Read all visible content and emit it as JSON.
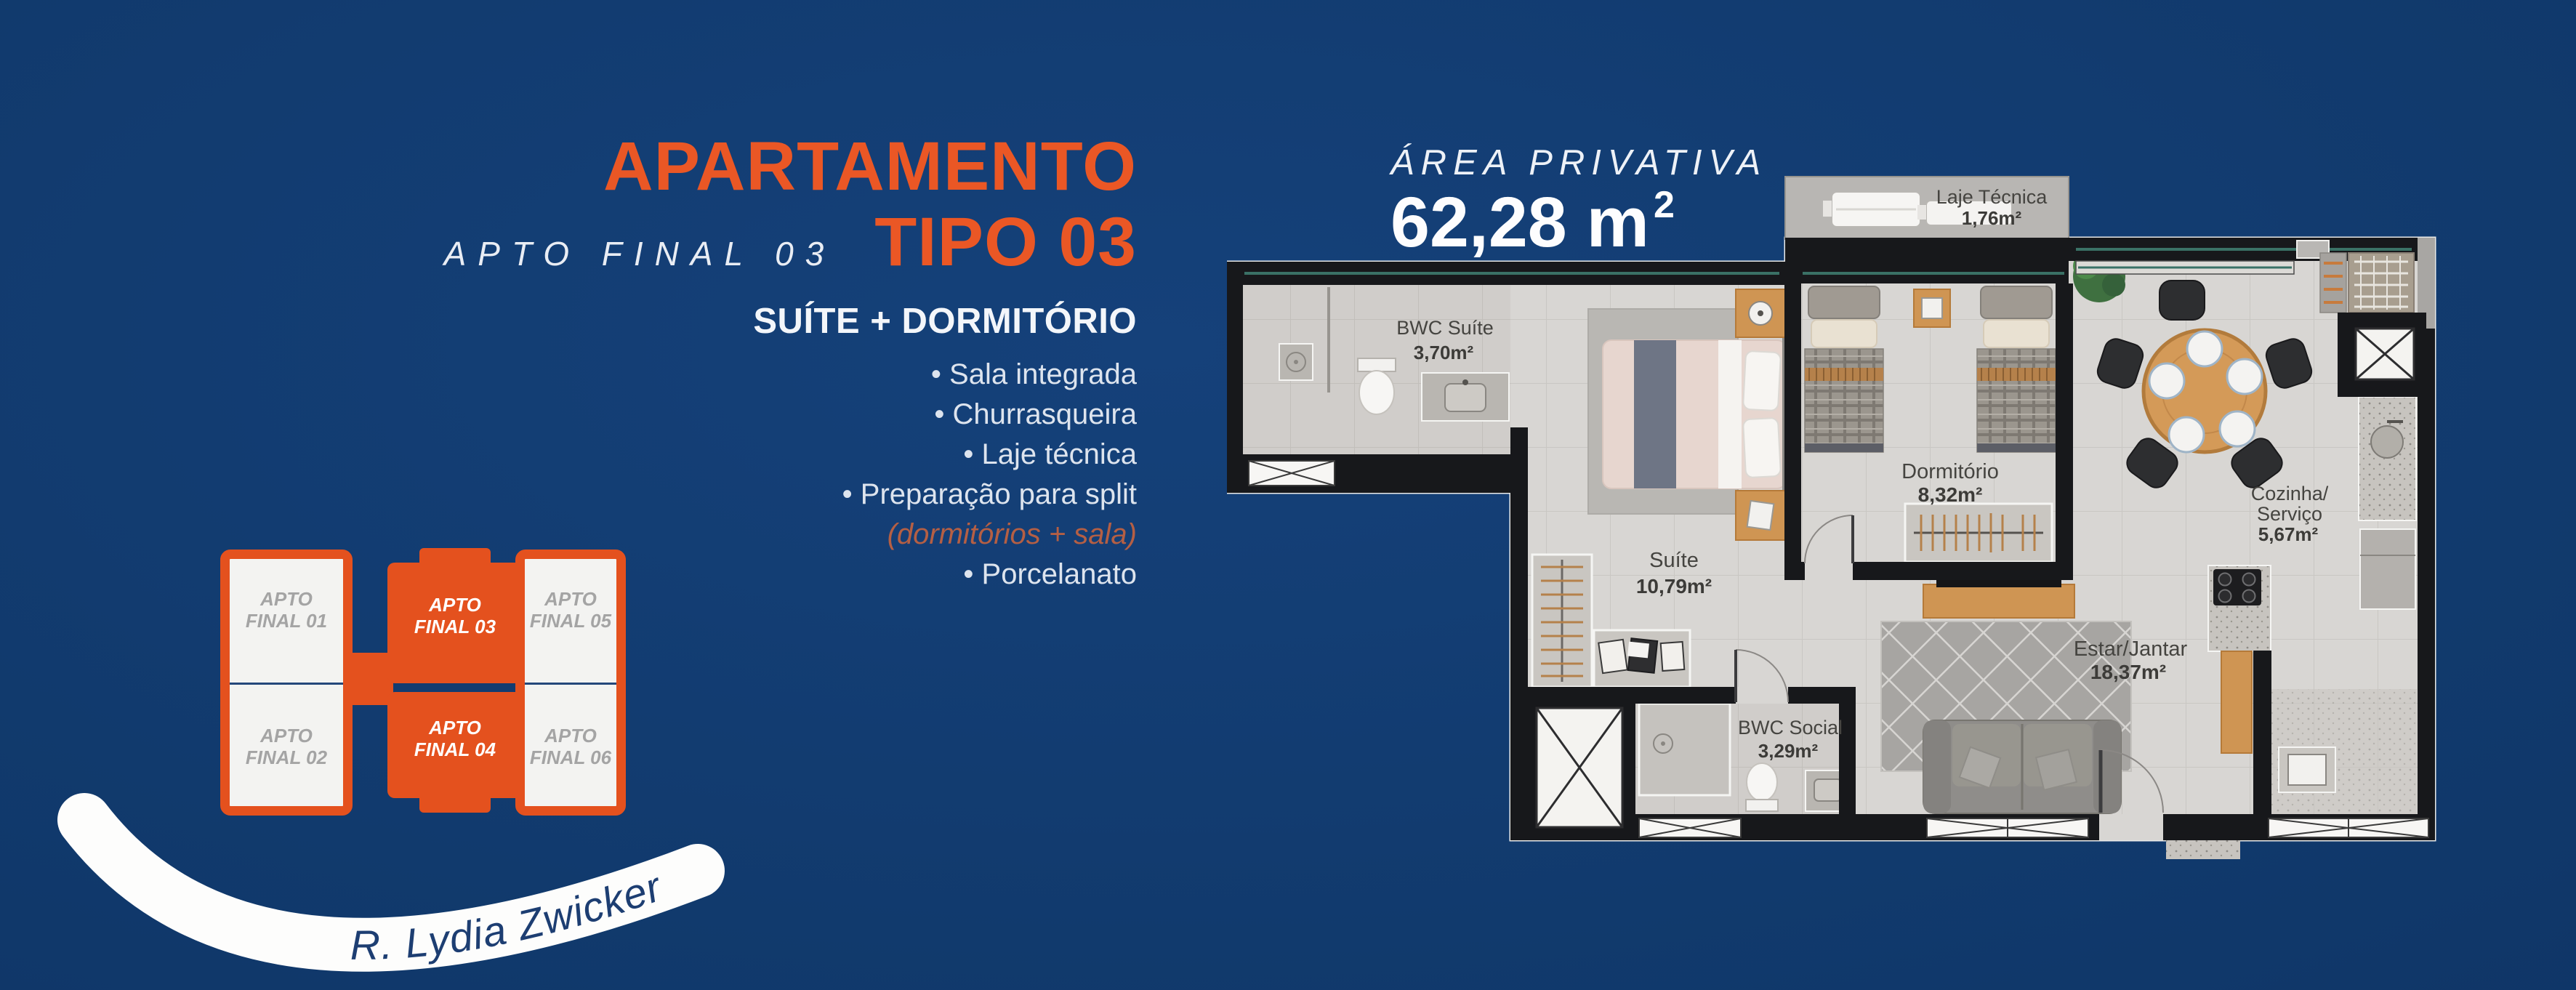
{
  "header": {
    "title_line1": "APARTAMENTO",
    "title_line2": "TIPO 03",
    "apto_label": "APTO FINAL 03"
  },
  "features": {
    "heading": "SUÍTE + DORMITÓRIO",
    "items": [
      "• Sala integrada",
      "• Churrasqueira",
      "• Laje técnica",
      "• Preparação para split"
    ],
    "note": "(dormitórios + sala)",
    "item_last": "• Porcelanato"
  },
  "key_plan": {
    "units": [
      {
        "label": "APTO FINAL 01",
        "highlighted": false
      },
      {
        "label": "APTO FINAL 02",
        "highlighted": false
      },
      {
        "label": "APTO FINAL 03",
        "highlighted": true
      },
      {
        "label": "APTO FINAL 04",
        "highlighted": true
      },
      {
        "label": "APTO FINAL 05",
        "highlighted": false
      },
      {
        "label": "APTO FINAL 06",
        "highlighted": false
      }
    ]
  },
  "street": {
    "name": "R. Lydia Zwicker"
  },
  "plan": {
    "area_label": "ÁREA PRIVATIVA",
    "area_value": "62,28 m",
    "area_sup": "2",
    "rooms": {
      "laje": {
        "name": "Laje Técnica",
        "area": "1,76m²"
      },
      "bwc_suite": {
        "name": "BWC Suíte",
        "area": "3,70m²"
      },
      "suite": {
        "name": "Suíte",
        "area": "10,79m²"
      },
      "dorm": {
        "name": "Dormitório",
        "area": "8,32m²"
      },
      "cozinha": {
        "name_line1": "Cozinha/",
        "name_line2": "Serviço",
        "area": "5,67m²"
      },
      "estar": {
        "name": "Estar/Jantar",
        "area": "18,37m²"
      },
      "bwc_social": {
        "name": "BWC Social",
        "area": "3,29m²"
      }
    }
  },
  "colors": {
    "accent_orange": "#ea5725",
    "keyplan_orange": "#e4511e",
    "note_salmon": "#b55f44",
    "background_navy": "#113a6d"
  }
}
